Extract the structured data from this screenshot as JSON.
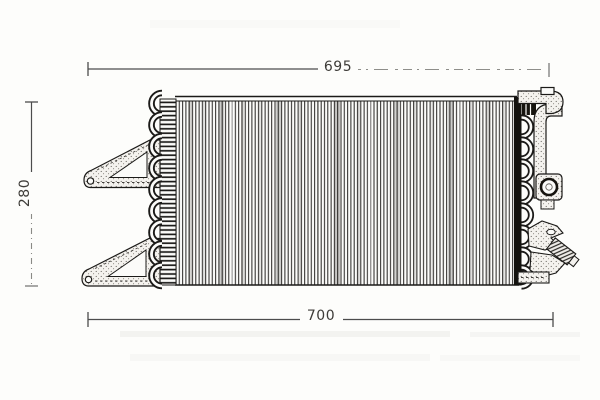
{
  "drawing": {
    "labels": {
      "width_top": "695",
      "width_bottom": "700",
      "height_left": "280"
    },
    "colors": {
      "ink": "#1b1a18",
      "dimension_line": "#4c4c4c",
      "paper": "#fdfdfb"
    }
  }
}
